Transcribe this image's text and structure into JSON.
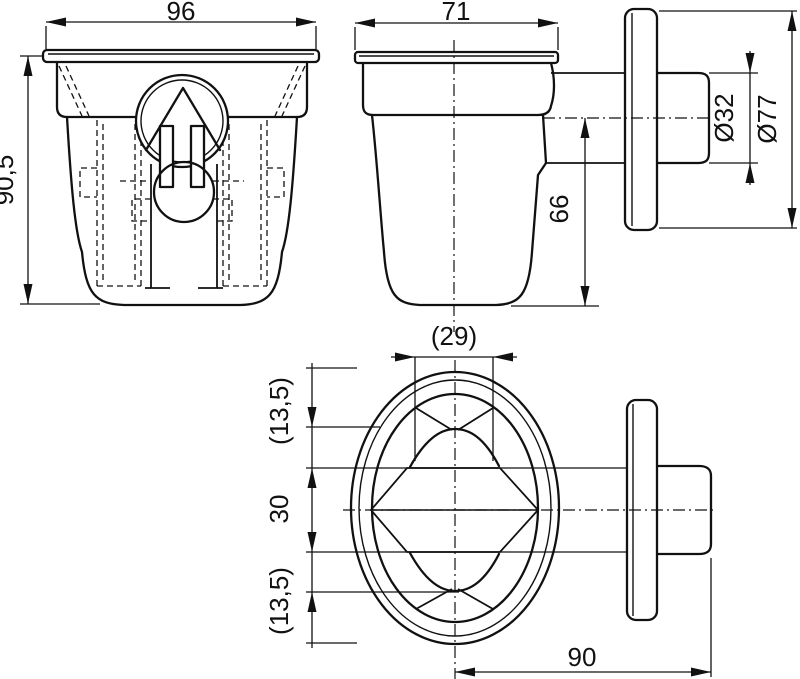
{
  "drawing": {
    "colors": {
      "line": "#111111",
      "background": "#ffffff"
    },
    "dims": {
      "front_width": "96",
      "front_height": "90,5",
      "side_width": "71",
      "axis_to_bottom": "66",
      "pipe_diameter": "Ø32",
      "flange_diameter": "Ø77",
      "grate_width": "(29)",
      "slot_upper": "(13,5)",
      "outlet_band": "30",
      "slot_lower": "(13,5)",
      "side_length": "90"
    }
  }
}
